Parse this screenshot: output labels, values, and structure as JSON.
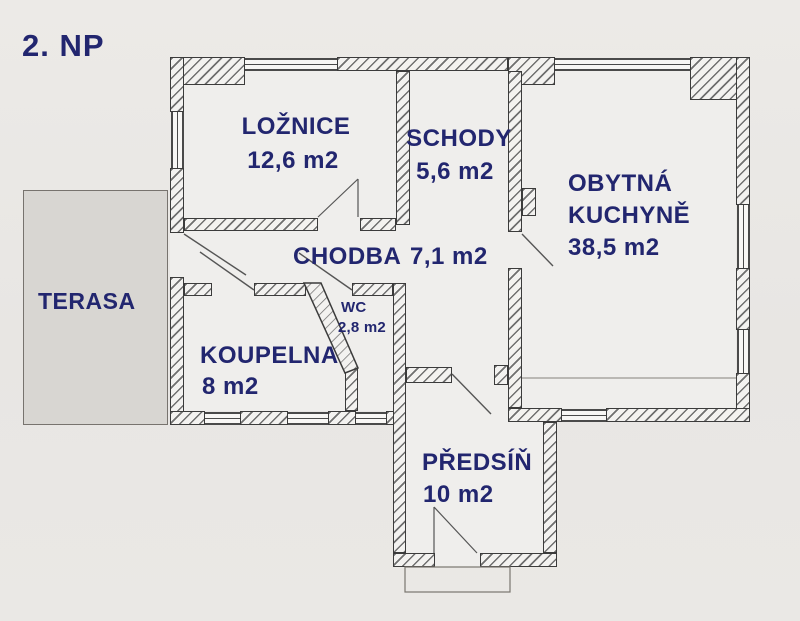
{
  "title": "2. NP",
  "rooms": {
    "loznice": {
      "name": "LOŽNICE",
      "area": "12,6 m2"
    },
    "schody": {
      "name": "SCHODY",
      "area": "5,6 m2"
    },
    "kuchyne": {
      "name1": "OBYTNÁ",
      "name2": "KUCHYNĚ",
      "area": "38,5 m2"
    },
    "chodba": {
      "name": "CHODBA",
      "area": "7,1 m2"
    },
    "wc": {
      "name": "WC",
      "area": "2,8 m2"
    },
    "terasa": {
      "name": "TERASA"
    },
    "koupelna": {
      "name": "KOUPELNA",
      "area": "8 m2"
    },
    "predsin": {
      "name": "PŘEDSÍŇ",
      "area": "10 m2"
    }
  },
  "colors": {
    "label_text": "#22266f",
    "wall_edge": "#3b3b3b",
    "terrace_fill": "#d8d6d2",
    "background": "#e9e7e4"
  }
}
